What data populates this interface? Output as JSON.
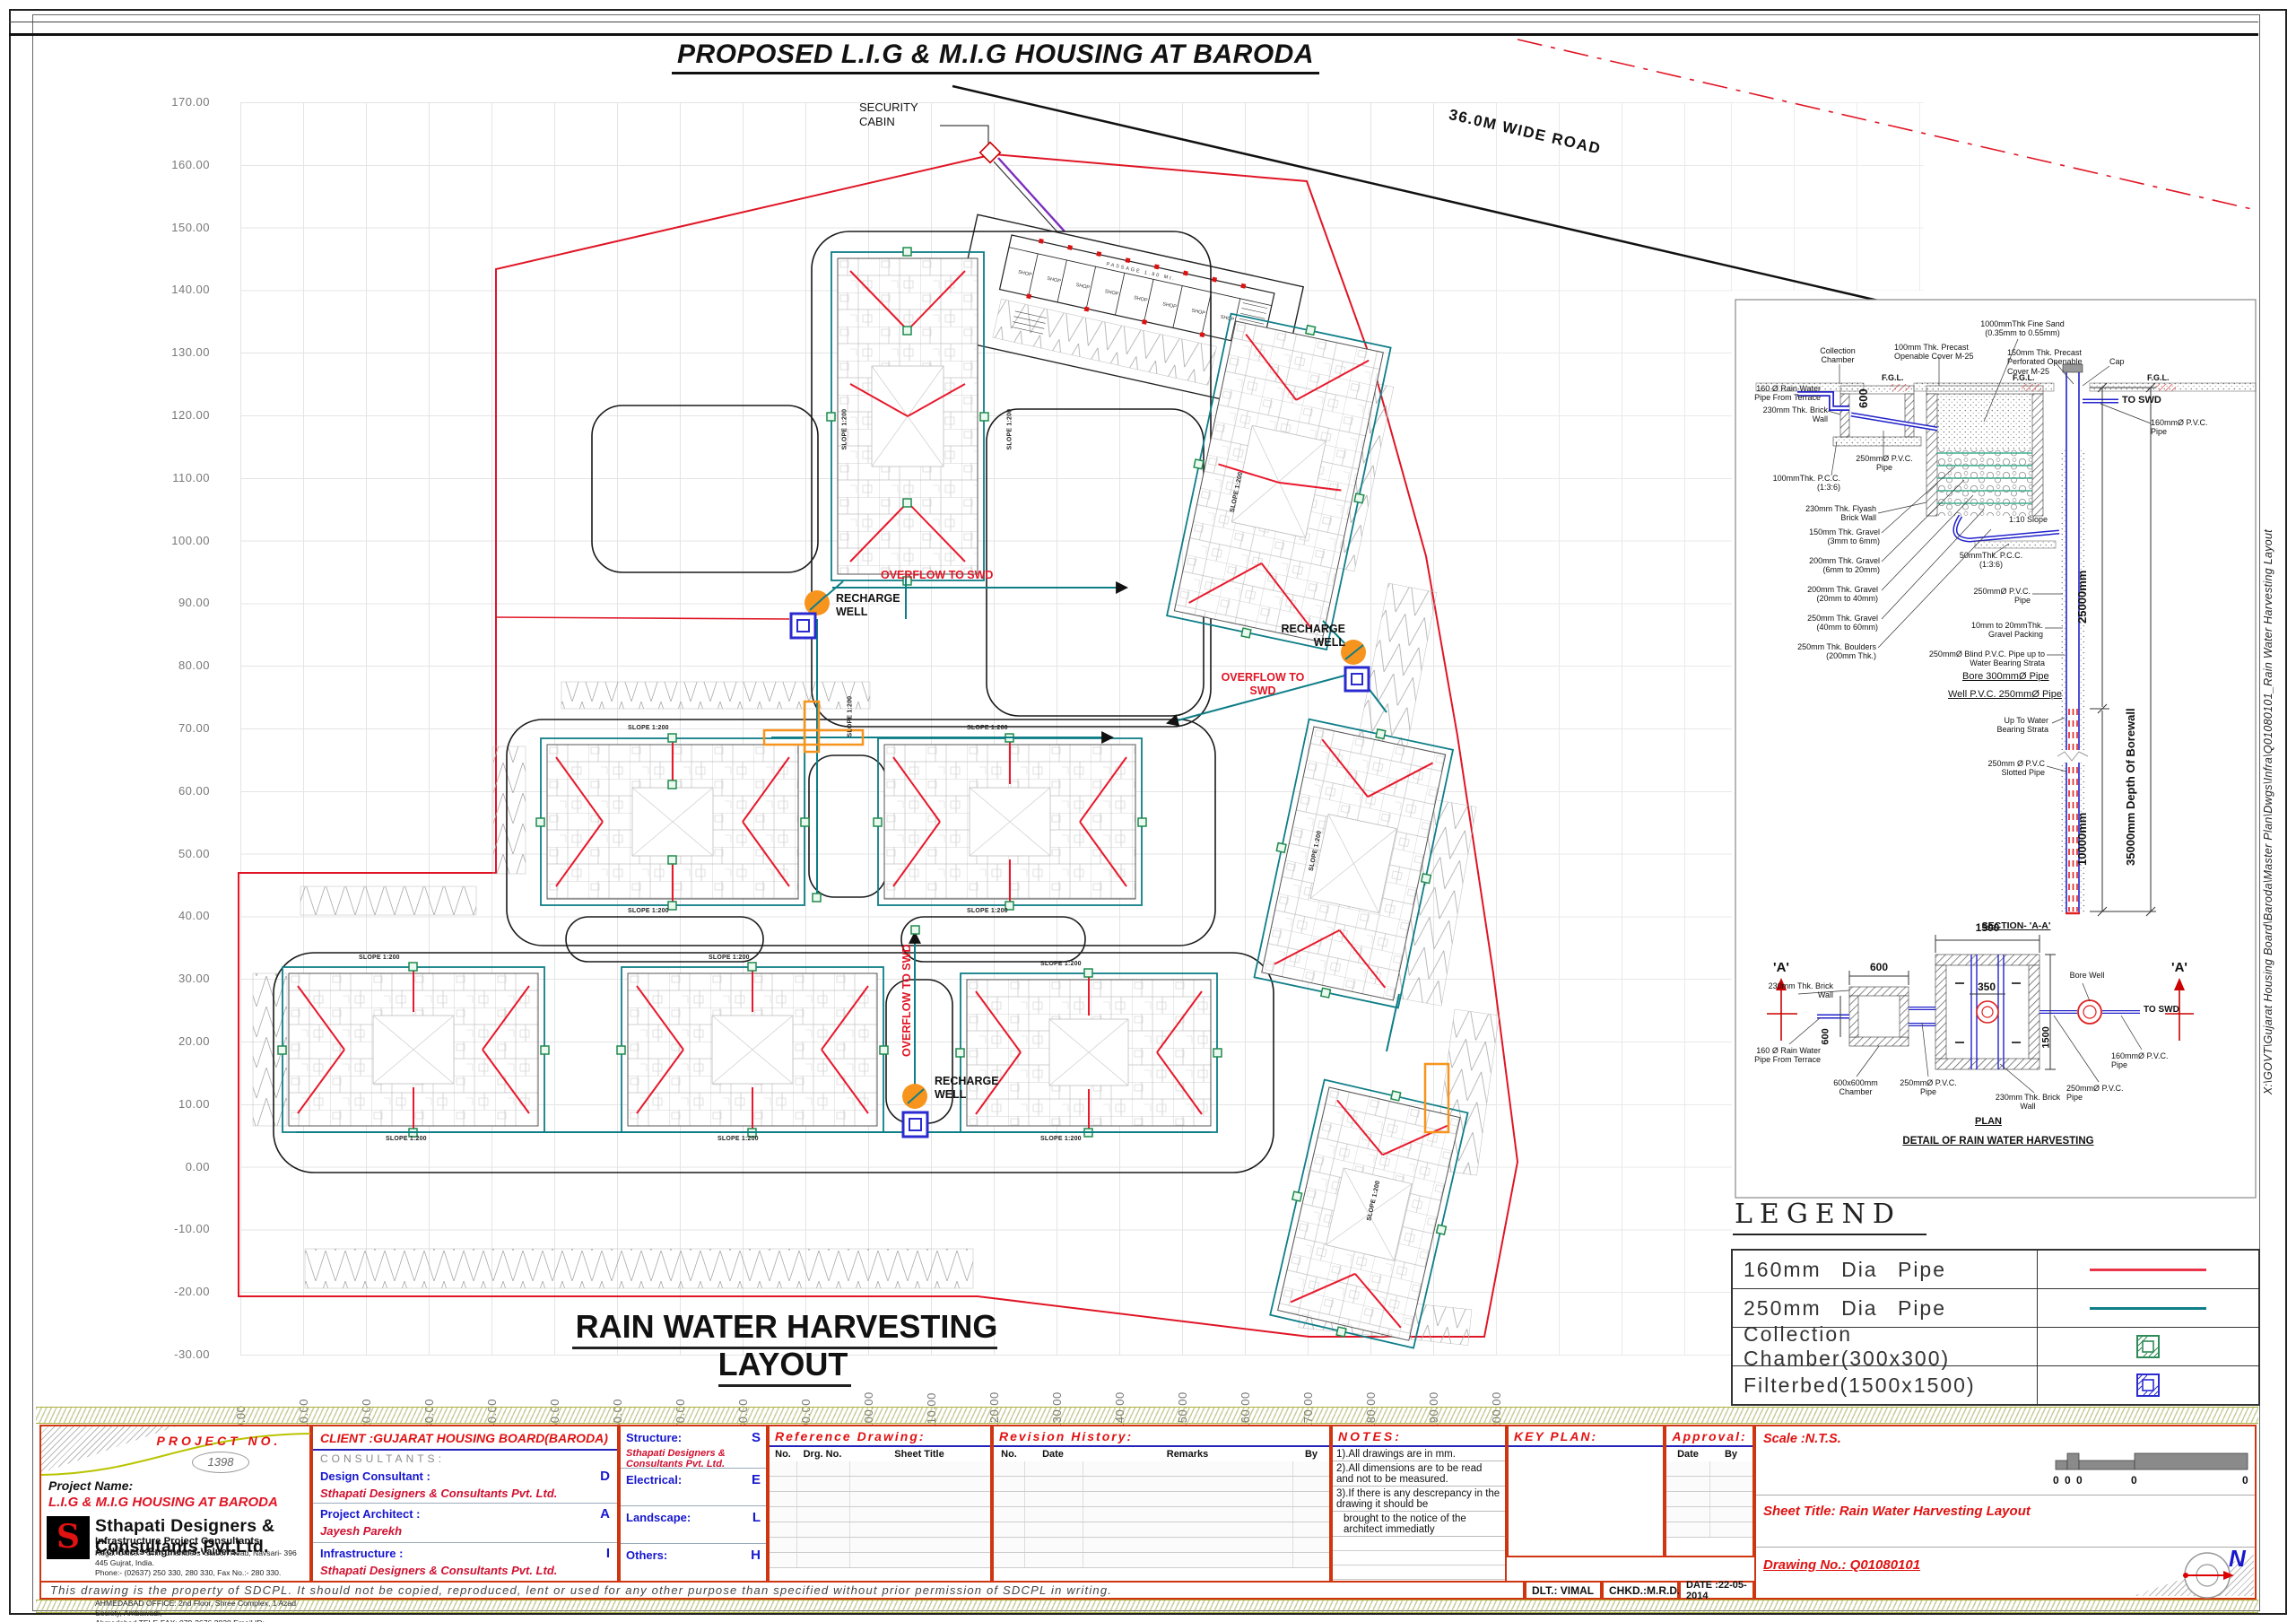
{
  "sheet": {
    "title": "PROPOSED L.I.G & M.I.G HOUSING AT BARODA",
    "plan_title": "RAIN WATER HARVESTING LAYOUT",
    "file_path": "X:\\GOVT\\Gujarat Housing Board\\Baroda\\Master Plan\\Dwgs\\Infra\\Q01080101_Rain Water Harvesting Layout"
  },
  "axes": {
    "left": [
      "170.00",
      "160.00",
      "150.00",
      "140.00",
      "130.00",
      "120.00",
      "110.00",
      "100.00",
      "90.00",
      "80.00",
      "70.00",
      "60.00",
      "50.00",
      "40.00",
      "30.00",
      "20.00",
      "10.00",
      "0.00",
      "-10.00",
      "-20.00",
      "-30.00"
    ],
    "bottom": [
      "0.00",
      "10.00",
      "20.00",
      "30.00",
      "40.00",
      "50.00",
      "60.00",
      "70.00",
      "80.00",
      "90.00",
      "100.00",
      "110.00",
      "120.00",
      "130.00",
      "140.00",
      "150.00",
      "160.00",
      "170.00",
      "180.00",
      "190.00",
      "200.00"
    ]
  },
  "plan": {
    "road_label": "36.0M WIDE ROAD",
    "security_cabin": "SECURITY CABIN",
    "recharge_well": "RECHARGE WELL",
    "overflow": "OVERFLOW TO SWD",
    "slope_label": "SLOPE 1:200",
    "shop_label": "SHOP",
    "passage_label": "PASSAGE 1.80 Mt."
  },
  "detail": {
    "fine_sand": "1000mmThk Fine Sand (0.35mm to 0.55mm)",
    "collection_chamber": "Collection Chamber",
    "precast_cover": "100mm Thk. Precast Openable Cover M-25",
    "perforated_cover": "150mm Thk. Precast Perforated Openable Cover M-25",
    "cap": "Cap",
    "fgl": "F.G.L.",
    "to_swd": "TO SWD",
    "rain_pipe_terrace": "160 Ø Rain Water Pipe From Terrace",
    "brick_wall": "230mm Thk. Brick Wall",
    "dim_600": "600",
    "pvc_250": "250mmØ P.V.C. Pipe",
    "pcc_100": "100mmThk. P.C.C. (1:3:6)",
    "flyash_wall": "230mm Thk. Flyash Brick Wall",
    "gravel_150": "150mm Thk. Gravel (3mm to 6mm)",
    "gravel_200a": "200mm Thk. Gravel (6mm to 20mm)",
    "gravel_200b": "200mm Thk. Gravel (20mm to 40mm)",
    "gravel_250": "250mm Thk. Gravel (40mm to 60mm)",
    "boulders": "250mm Thk. Boulders (200mm Thk.)",
    "pcc_50": "50mmThk. P.C.C. (1:3:6)",
    "slope_110": "1:10 Slope",
    "pvc_160": "160mmØ P.V.C. Pipe",
    "gravel_packing": "10mm to 20mmThk. Gravel Packing",
    "blind_pipe": "250mmØ Blind P.V.C. Pipe up to Water Bearing Strata",
    "bore_pipe": "Bore 300mmØ Pipe",
    "well_pipe": "Well P.V.C. 250mmØ Pipe",
    "up_to_water": "Up To Water Bearing Strata",
    "slotted_pipe": "250mm Ø P.V.C Slotted Pipe",
    "dim_25000": "25000mm",
    "dim_10000": "10000mm",
    "dim_35000": "35000mm Depth Of Borewall",
    "section_aa": "SECTION- 'A-A'",
    "marker_a": "'A'",
    "dim_1500": "1500",
    "dim_350": "350",
    "bore_well": "Bore Well",
    "chamber_600": "600x600mm Chamber",
    "plan_label": "PLAN",
    "detail_title": "DETAIL OF RAIN WATER HARVESTING"
  },
  "legend": {
    "title": "LEGEND",
    "rows": [
      {
        "label": "160mm Dia Pipe",
        "symbol": "red-line",
        "color": "#e8354a"
      },
      {
        "label": "250mm Dia Pipe",
        "symbol": "teal-line",
        "color": "#0e7e87"
      },
      {
        "label": "Collection Chamber(300x300)",
        "symbol": "green-chamber",
        "color": "#2e8b57"
      },
      {
        "label": "Filterbed(1500x1500)",
        "symbol": "blue-filterbed",
        "color": "#2a2ad0"
      }
    ]
  },
  "titleblock": {
    "project_no_label": "PROJECT NO.",
    "project_no": "1398",
    "project_name_label": "Project Name:",
    "project_name": "L.I.G & M.I.G HOUSING AT BARODA",
    "firm": "Sthapati Designers & Consultants Pvt.Ltd.",
    "firm_sub": "Infrastructure Project Consultants Architects-Engineers-Valuers.",
    "firm_addr": [
      "Regd. Office:- 'Ohm Chambers' Station Road, Navsari- 396 445 Gujrat, India.",
      "Phone:- (02637) 250 330, 280 330, Fax No.:- 280 330.",
      "Email ID:- sdcplin@yahoo.com, Web Site:- www.sthapati-india.com",
      "AHMEDABAD OFFICE: 2nd Floor, Shree Complex, 1 Azad Society, Ambawadi,",
      "Ahmedabad  TELE-FAX: 079-2676 2838 Email ID:- abedarch@gmail.com"
    ],
    "client": "CLIENT :GUJARAT HOUSING BOARD(BARODA)",
    "consultants_heading": "CONSULTANTS:",
    "consultants": [
      {
        "role": "Design Consultant :",
        "code": "D",
        "name": "Sthapati Designers & Consultants Pvt. Ltd."
      },
      {
        "role": "Project Architect :",
        "code": "A",
        "name": "Jayesh Parekh"
      },
      {
        "role": "Infrastructure :",
        "code": "I",
        "name": "Sthapati Designers & Consultants Pvt. Ltd."
      }
    ],
    "disciplines": [
      {
        "role": "Structure:",
        "code": "S",
        "name": "Sthapati Designers & Consultants Pvt. Ltd."
      },
      {
        "role": "Electrical:",
        "code": "E",
        "name": ""
      },
      {
        "role": "Landscape:",
        "code": "L",
        "name": ""
      },
      {
        "role": "Others:",
        "code": "H",
        "name": ""
      }
    ],
    "reference_heading": "Reference Drawing:",
    "reference_cols": [
      "No.",
      "Drg. No.",
      "Sheet Title"
    ],
    "revision_heading": "Revision History:",
    "revision_cols": [
      "No.",
      "Date",
      "Remarks",
      "By"
    ],
    "notes_heading": "NOTES:",
    "notes": [
      "1).All drawings are in mm.",
      "2).All dimensions are to be read and not to be measured.",
      "3).If there is any descrepancy in the drawing it should be",
      "brought to the  notice of the architect  immediatly"
    ],
    "keyplan_heading": "KEY PLAN:",
    "approval_heading": "Approval:",
    "approval_cols": [
      "Date",
      "By"
    ],
    "scale": "Scale :N.T.S.",
    "scale_zeros": [
      "0",
      "0",
      "0",
      "0",
      "0"
    ],
    "sheet_title": "Sheet Title: Rain Water Harvesting Layout",
    "drawing_no": "Drawing No.: Q01080101",
    "dlt": "DLT.: VIMAL",
    "chkd": "CHKD.:M.R.D.",
    "date": "DATE :22-05-2014",
    "north": "N",
    "disclaimer": "This drawing is the property of SDCPL. It should not be copied, reproduced, lent or used for any other purpose than specified without  prior permission of SDCPL in writing."
  }
}
